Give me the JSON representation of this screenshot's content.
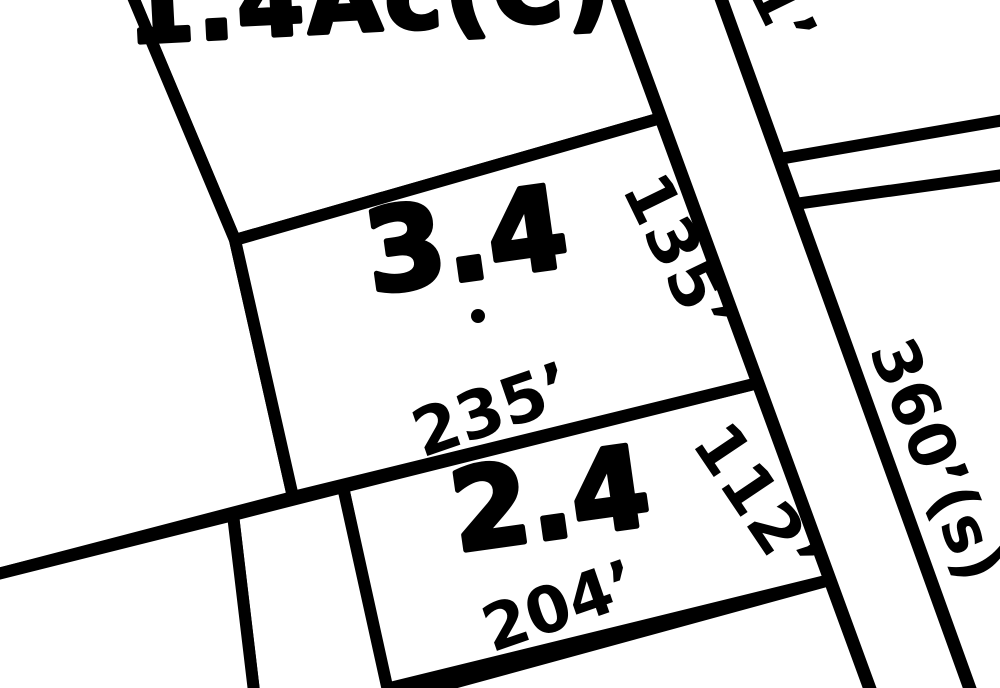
{
  "map": {
    "colors": {
      "highlight": "#ffe50d",
      "line": "#000000",
      "background": "#ffffff"
    },
    "parcels": {
      "top": {
        "label": "1.4Ac(C)"
      },
      "highlighted": {
        "label": "3.4"
      },
      "lower": {
        "label": "2.4"
      }
    },
    "dimensions": {
      "d235": "235’",
      "d135": "135’",
      "d112": "112’",
      "d204": "204’",
      "d360": "360’(s)",
      "d1": "1’"
    }
  }
}
